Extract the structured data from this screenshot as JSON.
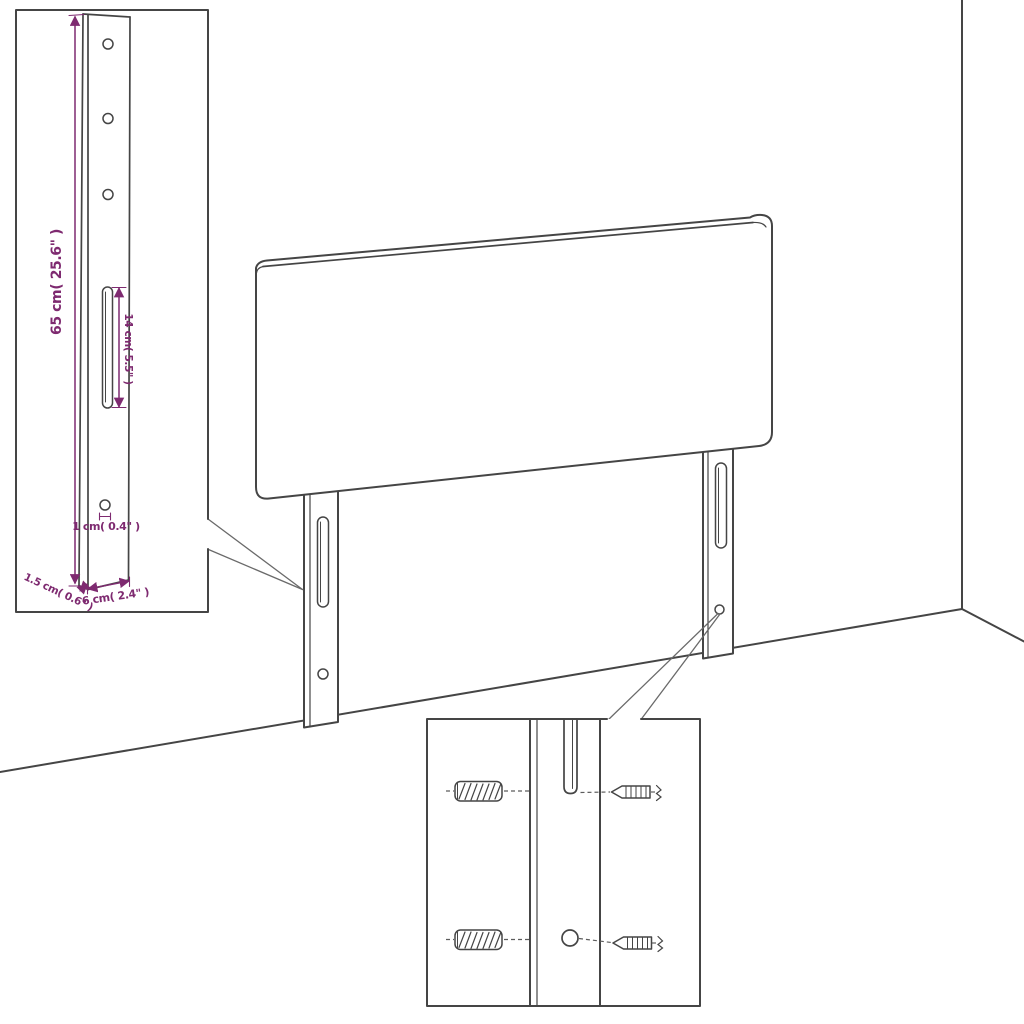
{
  "figure": {
    "kind": "Furniture assembly dimension diagram",
    "subject": "Headboard with two slotted mounting legs shown against a room corner",
    "insets": {
      "top_left": "Enlarged side view of mounting leg with dimension callouts",
      "bottom": "Enlarged detail of leg slot and screw hole with wall plugs and screws"
    }
  },
  "colors": {
    "background": "#ffffff",
    "line": "#454545",
    "accent": "#7e2a70"
  },
  "dimension_labels": {
    "leg_height": "65 cm( 25.6\" )",
    "slot_length": "14 cm( 5.5\" )",
    "hole_diameter": "1 cm( 0.4\" )",
    "leg_depth": "1.5 cm( 0.6\" )",
    "leg_width": "6 cm( 2.4\" )"
  }
}
